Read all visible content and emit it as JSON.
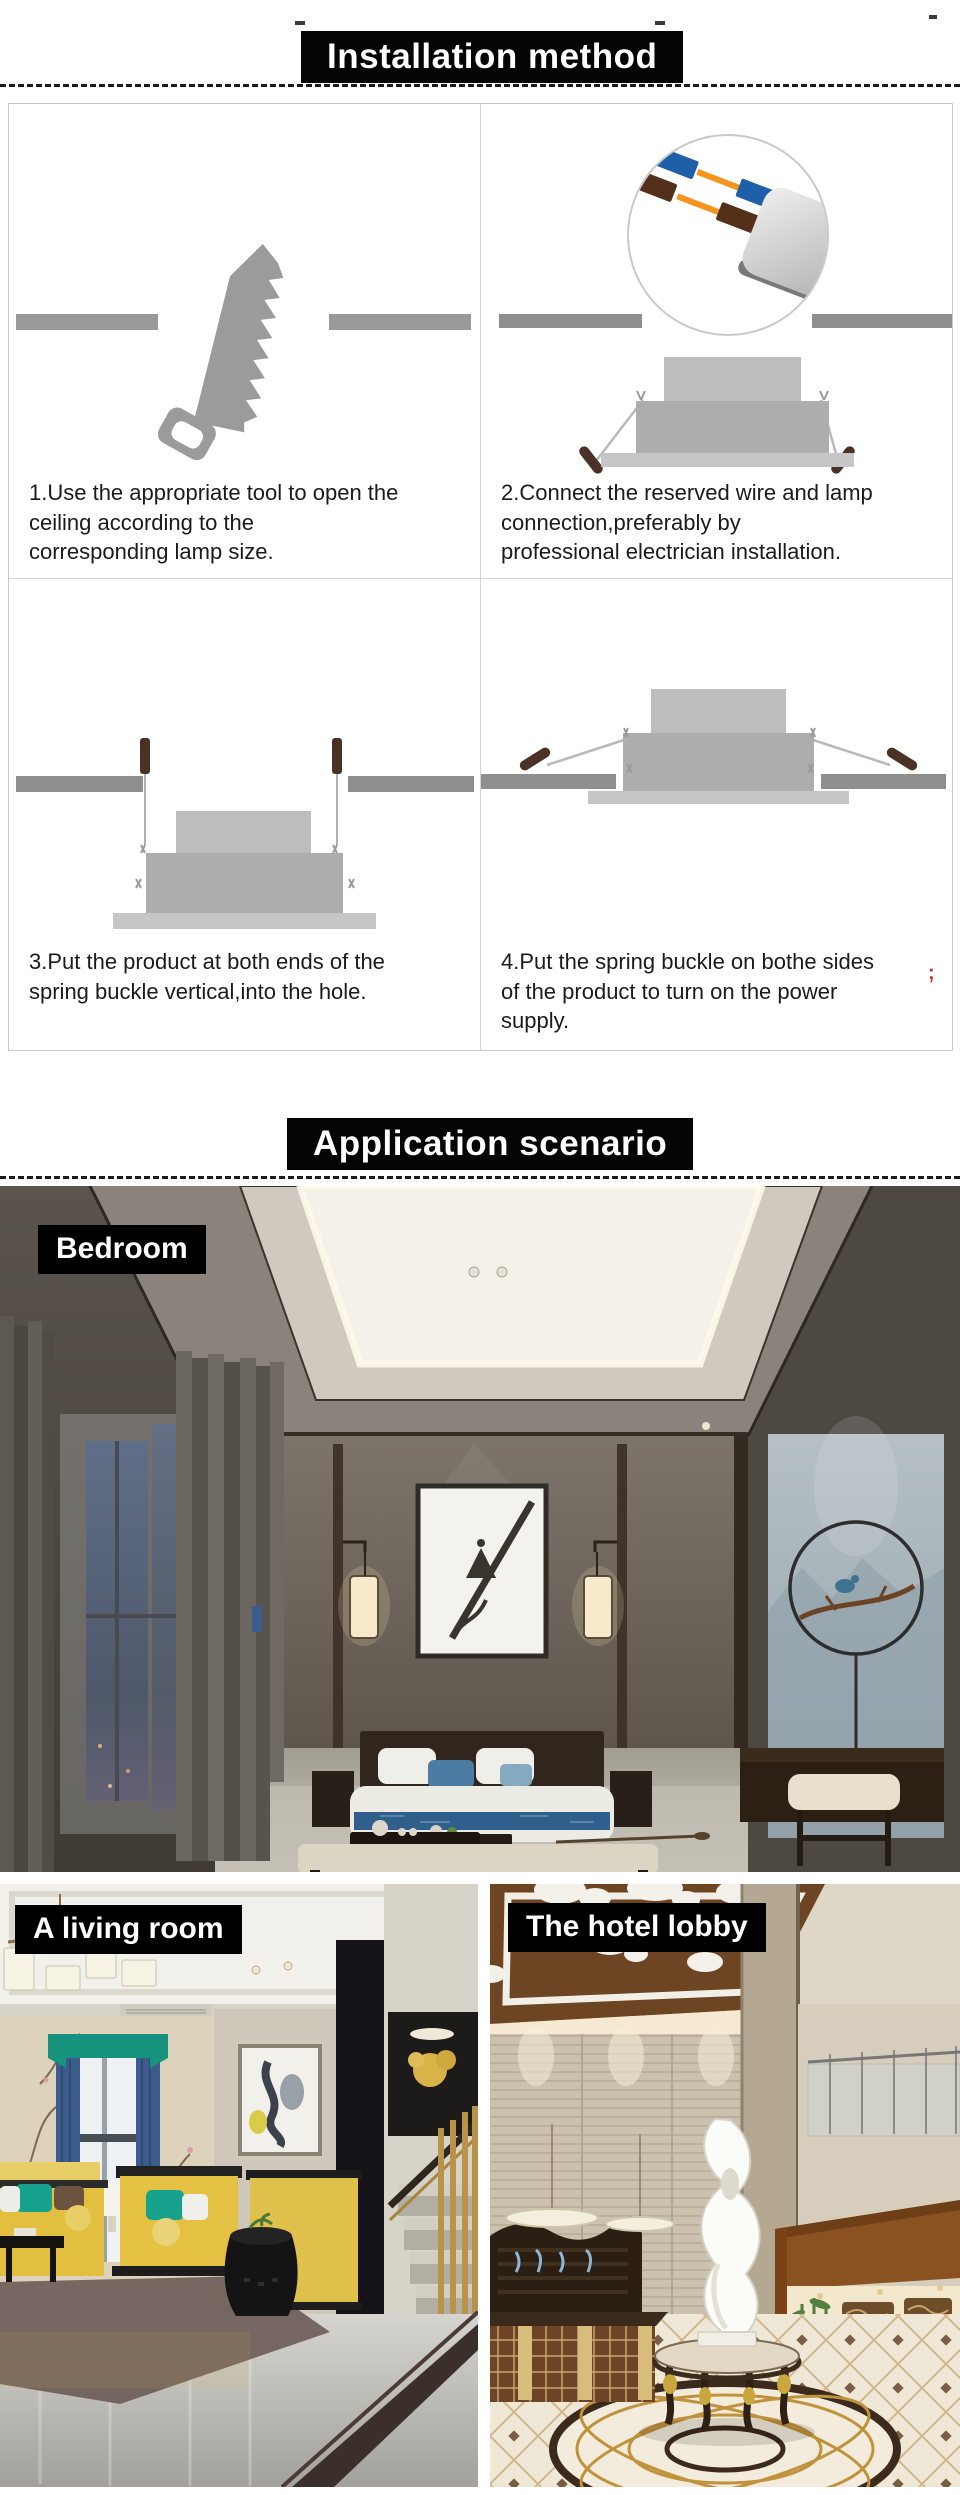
{
  "page": {
    "width": 960,
    "height": 2495,
    "background": "#ffffff"
  },
  "colors": {
    "header_bg": "#050505",
    "header_text": "#ffffff",
    "caption_text": "#1b1b1b",
    "table_border": "#c9c9c9",
    "diagram_gray": "#9b9b9b",
    "ceiling_bar_gray": "#8f8f8f",
    "wire_orange": "#f7941d",
    "wire_blue": "#1f5fa8",
    "wire_brown": "#53301a",
    "spring_tip_brown": "#4a3326",
    "stray_mark_red": "#cc3333"
  },
  "installation": {
    "title": "Installation method",
    "steps": [
      {
        "caption": "1.Use the appropriate tool to open the\nceiling according to the\ncorresponding lamp size.",
        "illustration": "saw-cutting-ceiling"
      },
      {
        "caption": "2.Connect the reserved wire and lamp\nconnection,preferably by\nprofessional electrician installation.",
        "illustration": "wire-connection-magnifier"
      },
      {
        "caption": "3.Put the product at both ends of the\nspring buckle vertical,into the hole.",
        "illustration": "spring-buckle-vertical"
      },
      {
        "caption": "4.Put the spring buckle on bothe sides\nof the product to turn on the power\nsupply.",
        "illustration": "spring-buckle-sides"
      }
    ],
    "stray_mark": ";"
  },
  "application": {
    "title": "Application scenario",
    "scenes": [
      {
        "label": "Bedroom"
      },
      {
        "label": "A living room"
      },
      {
        "label": "The hotel lobby"
      }
    ]
  }
}
